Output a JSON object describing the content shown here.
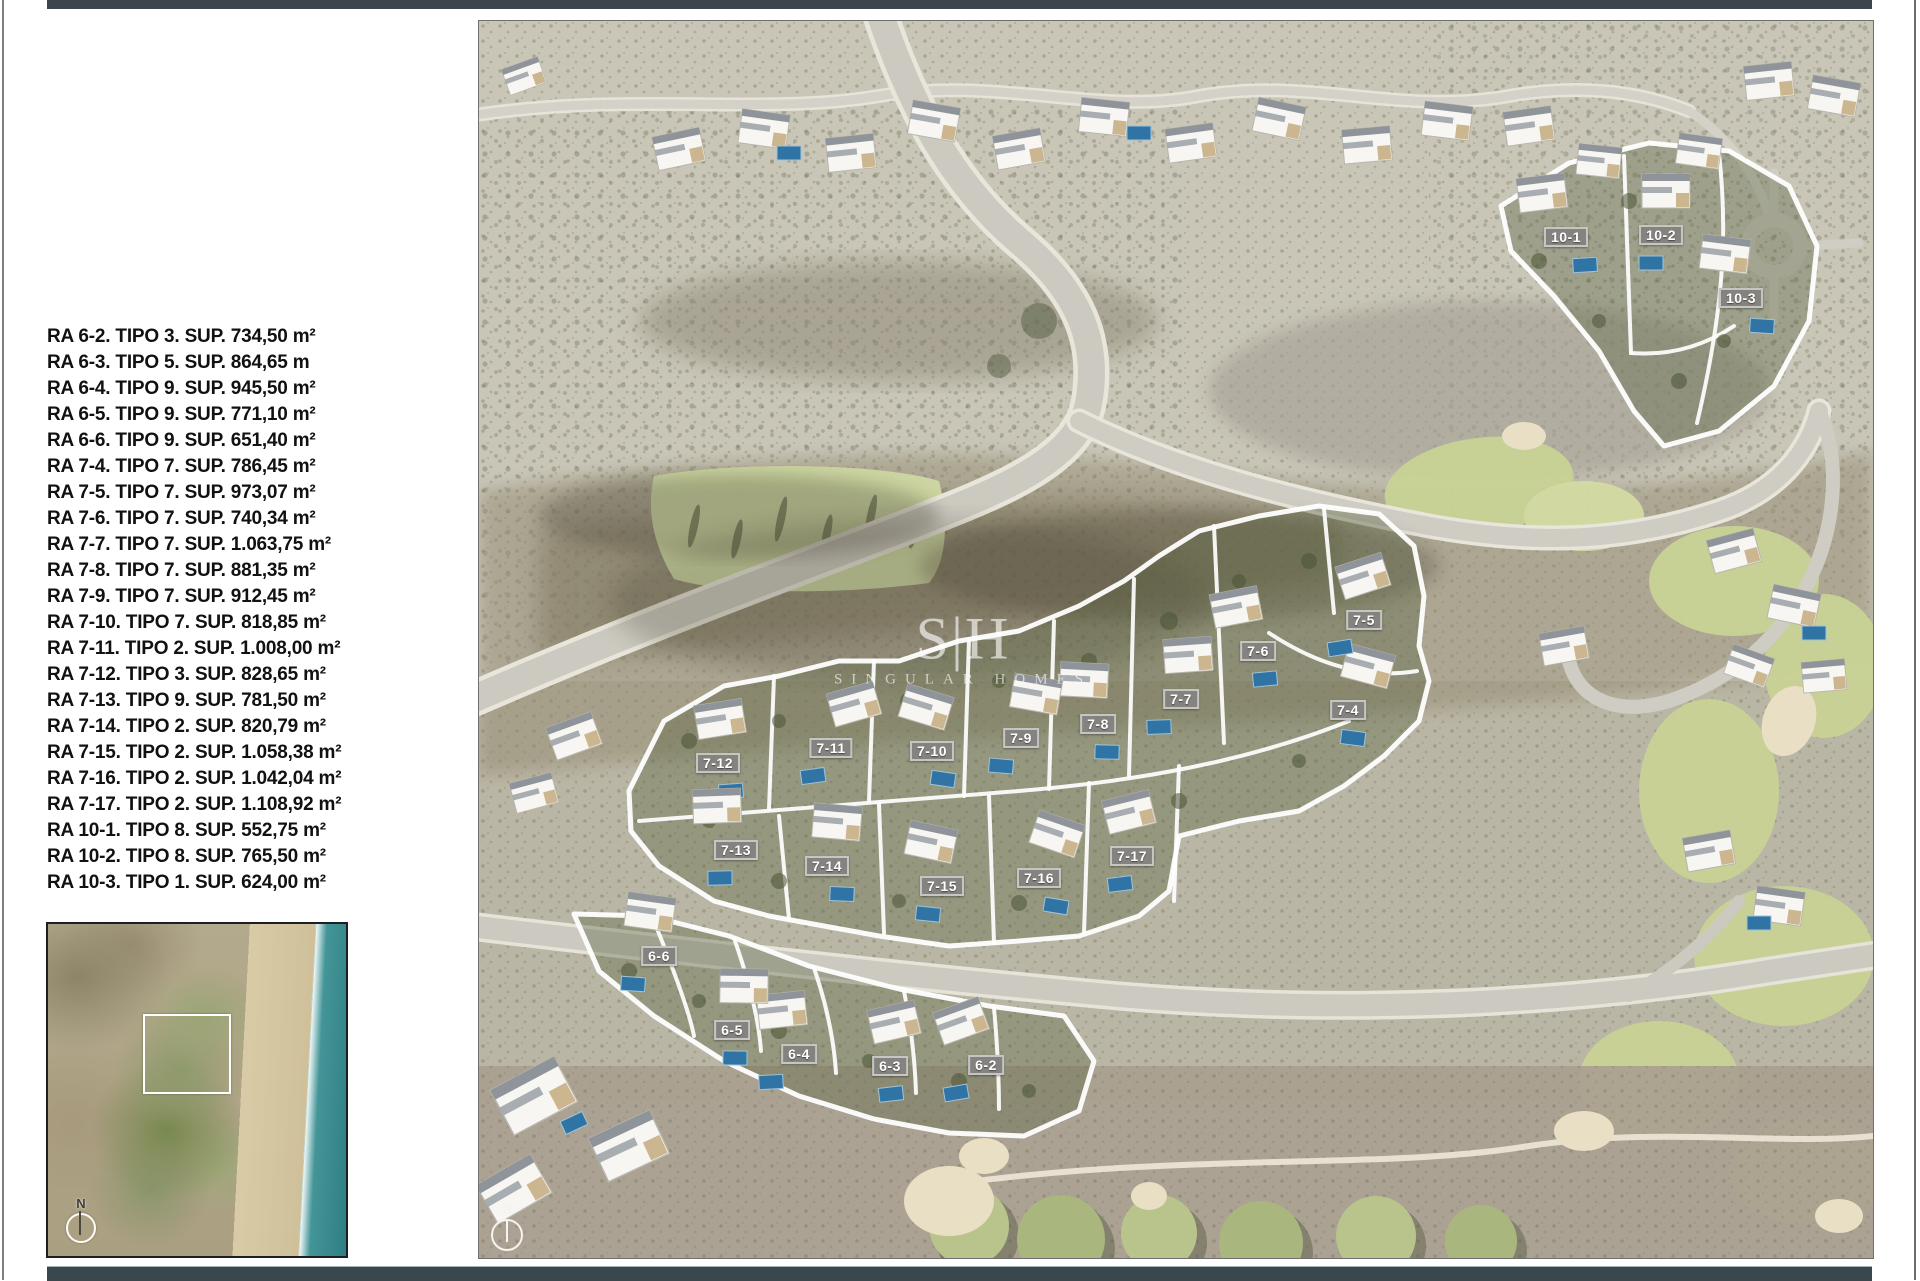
{
  "page": {
    "top_bar_color": "#3a454c",
    "bottom_bar_color": "#3a474d"
  },
  "legend": {
    "items": [
      "RA 6-2. TIPO 3. SUP. 734,50 m²",
      "RA 6-3. TIPO 5. SUP. 864,65 m",
      "RA 6-4. TIPO 9. SUP. 945,50 m²",
      "RA 6-5. TIPO 9. SUP. 771,10 m²",
      "RA 6-6. TIPO 9. SUP. 651,40 m²",
      "RA 7-4. TIPO 7. SUP. 786,45 m²",
      "RA 7-5. TIPO 7. SUP. 973,07 m²",
      "RA 7-6. TIPO 7. SUP. 740,34 m²",
      "RA 7-7. TIPO 7. SUP. 1.063,75 m²",
      "RA 7-8. TIPO 7. SUP. 881,35 m²",
      "RA 7-9. TIPO 7. SUP. 912,45 m²",
      "RA 7-10. TIPO 7. SUP. 818,85 m²",
      "RA 7-11. TIPO 2. SUP. 1.008,00 m²",
      "RA 7-12. TIPO 3. SUP. 828,65 m²",
      "RA 7-13. TIPO 9. SUP. 781,50 m²",
      "RA 7-14. TIPO 2. SUP. 820,79 m²",
      "RA 7-15. TIPO 2. SUP. 1.058,38 m²",
      "RA 7-16. TIPO 2. SUP. 1.042,04 m²",
      "RA 7-17. TIPO 2. SUP. 1.108,92 m²",
      "RA 10-1. TIPO 8. SUP. 552,75 m²",
      "RA 10-2. TIPO 8. SUP. 765,50 m²",
      "RA 10-3. TIPO 1. SUP. 624,00 m²"
    ]
  },
  "map": {
    "watermark": {
      "logo": "S|H",
      "subtitle": "SINGULAR HOMES"
    },
    "compass_label": "N",
    "plots": [
      {
        "id": "6-2",
        "x": 507,
        "y": 1044
      },
      {
        "id": "6-3",
        "x": 411,
        "y": 1045
      },
      {
        "id": "6-4",
        "x": 320,
        "y": 1033
      },
      {
        "id": "6-5",
        "x": 253,
        "y": 1009
      },
      {
        "id": "6-6",
        "x": 180,
        "y": 935
      },
      {
        "id": "7-4",
        "x": 869,
        "y": 689
      },
      {
        "id": "7-5",
        "x": 885,
        "y": 599
      },
      {
        "id": "7-6",
        "x": 779,
        "y": 630
      },
      {
        "id": "7-7",
        "x": 702,
        "y": 678
      },
      {
        "id": "7-8",
        "x": 619,
        "y": 703
      },
      {
        "id": "7-9",
        "x": 542,
        "y": 717
      },
      {
        "id": "7-10",
        "x": 453,
        "y": 730
      },
      {
        "id": "7-11",
        "x": 352,
        "y": 727
      },
      {
        "id": "7-12",
        "x": 239,
        "y": 742
      },
      {
        "id": "7-13",
        "x": 257,
        "y": 829
      },
      {
        "id": "7-14",
        "x": 348,
        "y": 845
      },
      {
        "id": "7-15",
        "x": 463,
        "y": 865
      },
      {
        "id": "7-16",
        "x": 560,
        "y": 857
      },
      {
        "id": "7-17",
        "x": 653,
        "y": 835
      },
      {
        "id": "10-1",
        "x": 1087,
        "y": 216
      },
      {
        "id": "10-2",
        "x": 1182,
        "y": 214
      },
      {
        "id": "10-3",
        "x": 1262,
        "y": 277
      }
    ]
  },
  "inset": {
    "compass_label": "N"
  }
}
